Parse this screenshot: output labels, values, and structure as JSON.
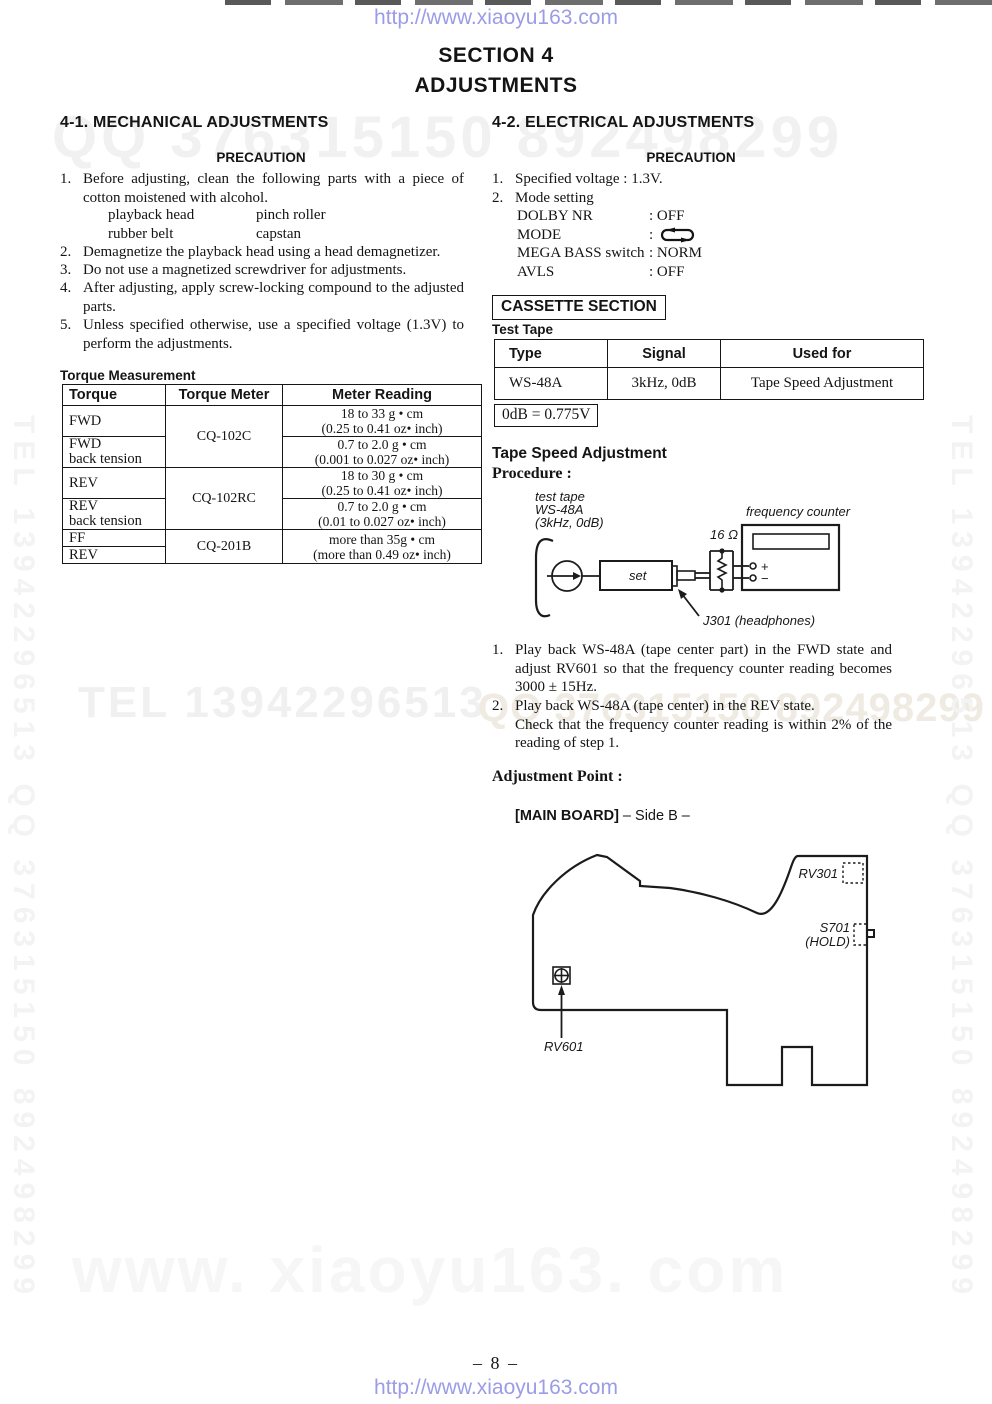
{
  "colors": {
    "link_blue": "#9b9ce6",
    "watermark_gray": "#f2f2f2",
    "ghost_tan": "#efebe3",
    "ink": "#141414"
  },
  "header": {
    "url": "http://www.xiaoyu163.com",
    "section_line1": "SECTION 4",
    "section_line2": "ADJUSTMENTS"
  },
  "watermarks": {
    "title_band": "QQ 376315150   892498299",
    "mid_left": "TEL  13942296513",
    "mid_right": "QQ 376315150  892498299",
    "left_vertical": "TEL 13942296513 QQ 376315150 892498299",
    "right_vertical": "TEL 13942296513 QQ 376315150 892498299",
    "bottom": "www. xiaoyu163. com"
  },
  "left": {
    "heading": "4-1. MECHANICAL ADJUSTMENTS",
    "precaution": "PRECAUTION",
    "item1_num": "1.",
    "item1": "Before adjusting, clean the following parts with a piece of cotton moistened with alcohol.",
    "parts": {
      "a": "playback head",
      "b": "pinch roller",
      "c": "rubber belt",
      "d": "capstan"
    },
    "item2_num": "2.",
    "item2": "Demagnetize the playback head using a head demagnetizer.",
    "item3_num": "3.",
    "item3": "Do not use a magnetized screwdriver for adjustments.",
    "item4_num": "4.",
    "item4": "After adjusting, apply screw-locking compound to the adjusted parts.",
    "item5_num": "5.",
    "item5": "Unless specified otherwise, use a specified voltage (1.3V) to perform the adjustments.",
    "torque_heading": "Torque Measurement",
    "torque_table": {
      "h1": "Torque",
      "h2": "Torque Meter",
      "h3": "Meter Reading",
      "r1c1": "FWD",
      "r12c2": "CQ-102C",
      "r1c3a": "18 to 33 g • cm",
      "r1c3b": "(0.25 to 0.41 oz• inch)",
      "r2c1a": "FWD",
      "r2c1b": "back tension",
      "r2c3a": "0.7 to 2.0 g • cm",
      "r2c3b": "(0.001 to 0.027 oz• inch)",
      "r3c1": "REV",
      "r34c2": "CQ-102RC",
      "r3c3a": "18 to 30 g • cm",
      "r3c3b": "(0.25 to 0.41 oz• inch)",
      "r4c1a": "REV",
      "r4c1b": "back tension",
      "r4c3a": "0.7 to 2.0 g • cm",
      "r4c3b": "(0.01 to 0.027 oz• inch)",
      "r5c1": "FF",
      "r56c2": "CQ-201B",
      "r56c3a": "more than 35g • cm",
      "r56c3b": "(more than 0.49 oz• inch)",
      "r6c1": "REV"
    }
  },
  "right": {
    "heading": "4-2. ELECTRICAL ADJUSTMENTS",
    "precaution": "PRECAUTION",
    "item1_num": "1.",
    "item1": "Specified voltage : 1.3V.",
    "item2_num": "2.",
    "item2": "Mode setting",
    "mode_rows": [
      {
        "label": "DOLBY NR",
        "value": ": OFF"
      },
      {
        "label": "MODE",
        "value": ":"
      },
      {
        "label": "MEGA BASS switch",
        "value": ": NORM"
      },
      {
        "label": "AVLS",
        "value": ": OFF"
      }
    ],
    "cassette_box": "CASSETTE SECTION",
    "test_tape": "Test Tape",
    "tape_table": {
      "h1": "Type",
      "h2": "Signal",
      "h3": "Used for",
      "r1c1": "WS-48A",
      "r1c2": "3kHz, 0dB",
      "r1c3": "Tape Speed Adjustment"
    },
    "db_note": "0dB = 0.775V",
    "tsa_heading": "Tape Speed Adjustment",
    "procedure": "Procedure :",
    "diagram": {
      "test_tape_l1": "test tape",
      "test_tape_l2": "WS-48A",
      "test_tape_l3": "(3kHz, 0dB)",
      "freq_counter": "frequency counter",
      "ohm": "16 Ω",
      "set": "set",
      "plus": "+",
      "minus": "−",
      "j301": "J301 (headphones)"
    },
    "step1_num": "1.",
    "step1": "Play back WS-48A (tape center part) in the FWD state and adjust RV601 so that the frequency counter reading becomes 3000 ± 15Hz.",
    "step2_num": "2.",
    "step2a": "Play back WS-48A (tape center) in the REV state.",
    "step2b": "Check that the frequency counter reading is within 2% of the reading of step 1.",
    "adj_point": "Adjustment Point :",
    "board_heading_bold": "[MAIN BOARD]",
    "board_heading_rest": " – Side B –",
    "board": {
      "rv301": "RV301",
      "s701": "S701",
      "hold": "(HOLD)",
      "rv601": "RV601"
    }
  },
  "footer": {
    "page": "– 8 –",
    "url": "http://www.xiaoyu163.com"
  }
}
